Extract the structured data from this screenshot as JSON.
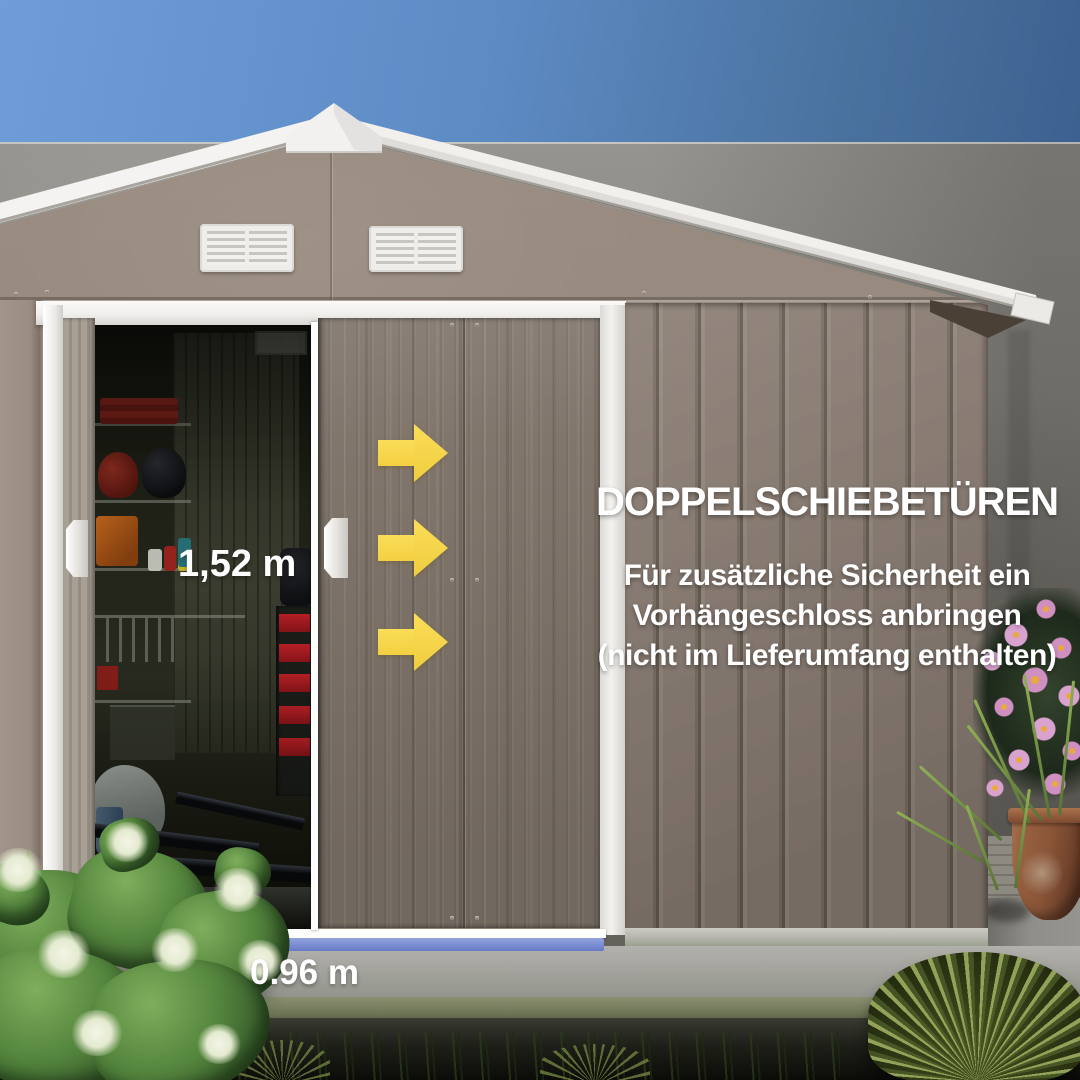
{
  "scene": {
    "description": "Produktfoto: Metall-Gerätehaus mit geöffneter Doppelschiebetür",
    "colors": {
      "accent_yellow": "#f7d84b",
      "measure_blue": "#7487cf",
      "text_white": "#ffffff",
      "sky_left": "#6f9dd9",
      "sky_right": "#3d6190",
      "shed_taupe": "#97897d",
      "trim_white": "#f2f1ee"
    }
  },
  "title": {
    "text": "DOPPELSCHIEBETÜREN"
  },
  "subtitle": {
    "lines": [
      "Für zusätzliche Sicherheit ein",
      "Vorhängeschloss anbringen",
      "(nicht im Lieferumfang enthalten)"
    ]
  },
  "measurements": {
    "door_height": "1,52 m",
    "door_width": "0.96 m"
  },
  "icons": {
    "arrows": [
      {
        "name": "arrow-right-icon"
      },
      {
        "name": "arrow-right-icon"
      },
      {
        "name": "arrow-right-icon"
      }
    ]
  }
}
